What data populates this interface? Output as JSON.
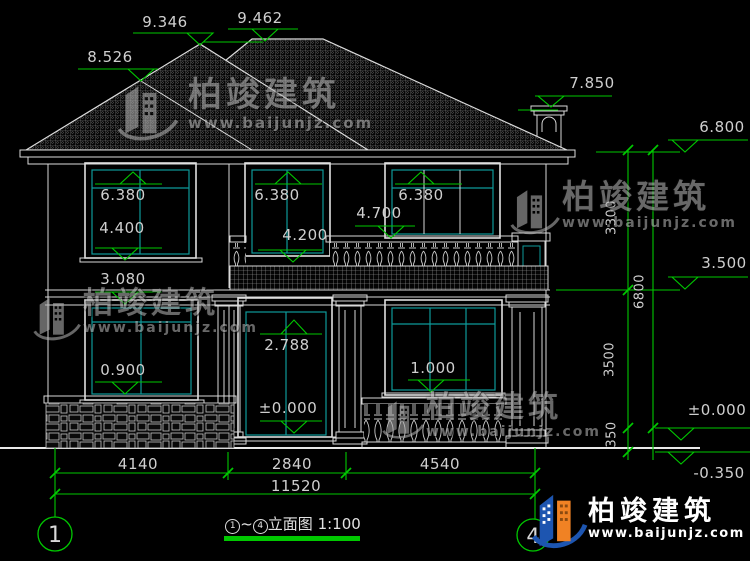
{
  "title": {
    "b1": "1",
    "tilde": "~",
    "b2": "4",
    "text": "立面图",
    "scale": "1:100"
  },
  "grid": {
    "left": "1",
    "right": "4"
  },
  "elev": {
    "ridge_left": "9.346",
    "ridge_main": "9.462",
    "hip_left": "8.526",
    "chimney": "7.850",
    "eave": "6.800",
    "mid_floor": "3.500",
    "zero_right": "±0.000",
    "below_ground": "-0.350",
    "w2l_top": "6.380",
    "w2l_sill": "4.400",
    "w2m_top": "6.380",
    "w2m_sill": "4.200",
    "balcony_rail": "4.700",
    "w2r_top": "6.380",
    "w1l_top": "3.080",
    "w1l_sill": "0.900",
    "door_top": "2.788",
    "door_zero": "±0.000",
    "w1r_sill": "1.000"
  },
  "vdims": {
    "upper": "3300",
    "total": "6800",
    "lower": "3500",
    "plinth": "350"
  },
  "hdims": {
    "left": "4140",
    "mid": "2840",
    "right": "4540",
    "total": "11520"
  },
  "watermark": {
    "brand": "柏竣建筑",
    "url": "www.baijunjz.com"
  },
  "logo": {
    "brand": "柏竣建筑",
    "url": "www.baijunjz.com"
  }
}
